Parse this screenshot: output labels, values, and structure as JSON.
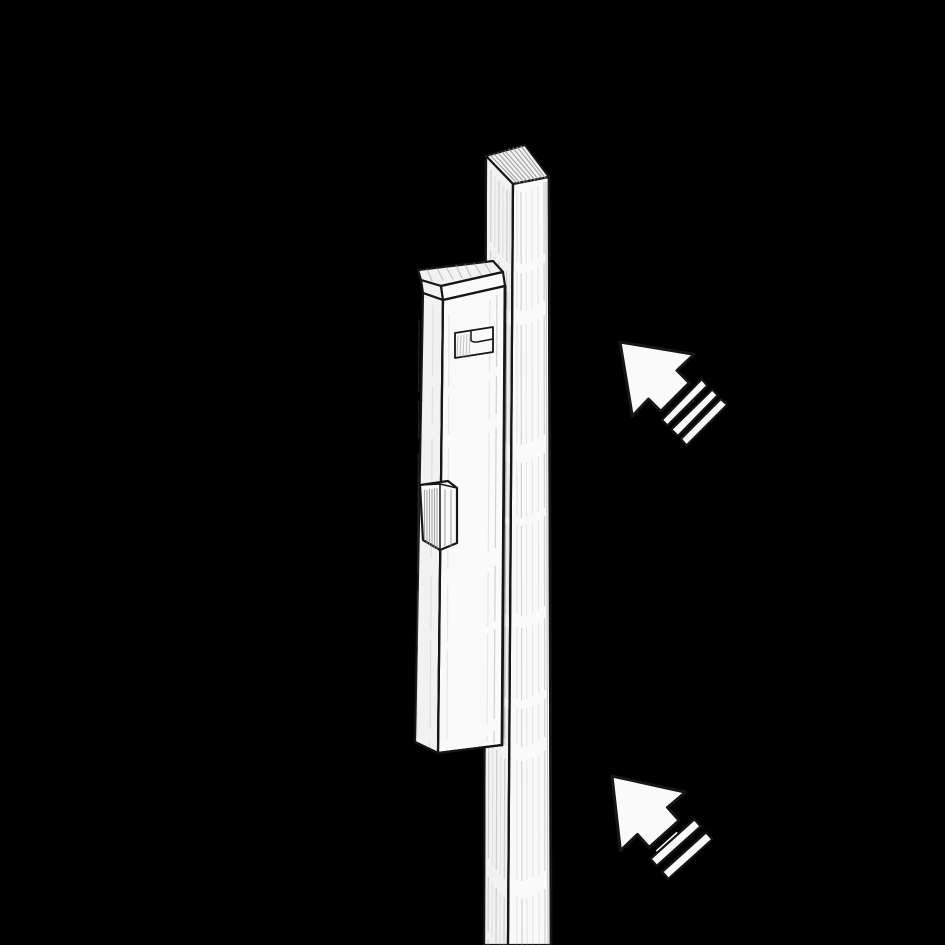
{
  "canvas": {
    "width": 945,
    "height": 945,
    "background_color": "#000000"
  },
  "illustration": {
    "style": "pencil-sketch line drawing on black background",
    "ink_color": "#161616",
    "paper_color": "#fafafa",
    "shaded_paper_color": "#f2f2f2",
    "hatch_color": "#8f8f8f",
    "objects": [
      {
        "id": "post",
        "label": "tall vertical post"
      },
      {
        "id": "bolt-body",
        "label": "surface bolt body mounted on post"
      },
      {
        "id": "bolt-cap",
        "label": "bolt cap (top)"
      },
      {
        "id": "slide-knob",
        "label": "bolt slide knob"
      },
      {
        "id": "slot-plate",
        "label": "knob slot plate with step cutout"
      },
      {
        "id": "cursor-arrow-top",
        "label": "motion cursor arrow (upper right)",
        "direction": "up-left",
        "stripes": 3
      },
      {
        "id": "cursor-arrow-bottom",
        "label": "motion cursor arrow (lower right)",
        "direction": "up-left",
        "stripes": 2
      }
    ]
  }
}
